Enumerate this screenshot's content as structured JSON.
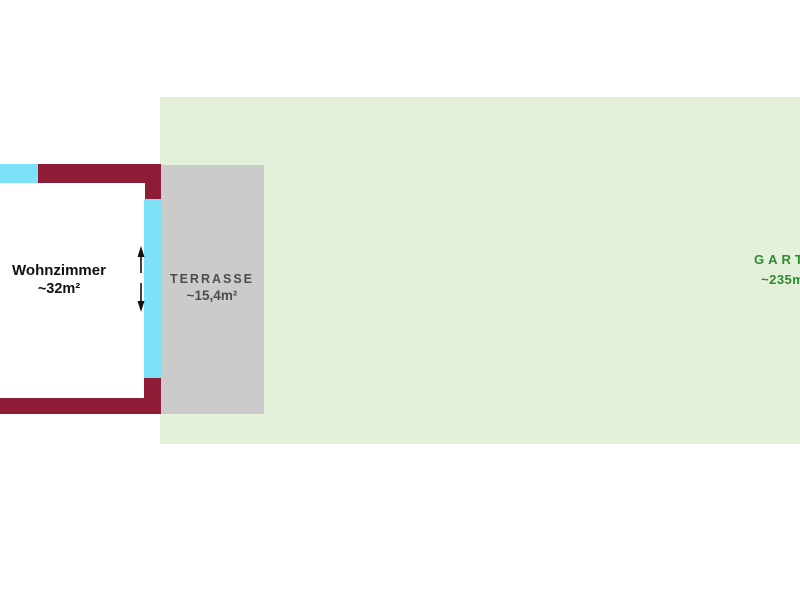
{
  "plan": {
    "wohnzimmer": {
      "label": "Wohnzimmer",
      "area": "~32m²"
    },
    "terrasse": {
      "label": "TERRASSE",
      "area": "~15,4m²"
    },
    "garten": {
      "label": "GARTEN",
      "area": "~235m²"
    }
  },
  "icons": {
    "door_arrows": "vertical-double-arrow"
  },
  "colors": {
    "wall": "#8e1c36",
    "window": "#7de1f7",
    "terrace_fill": "#cbcbcb",
    "terrace_text": "#4d4d4d",
    "garden_fill": "#e3f1da",
    "garden_text": "#2e8b2e",
    "room_text": "#111111",
    "background": "#ffffff"
  }
}
